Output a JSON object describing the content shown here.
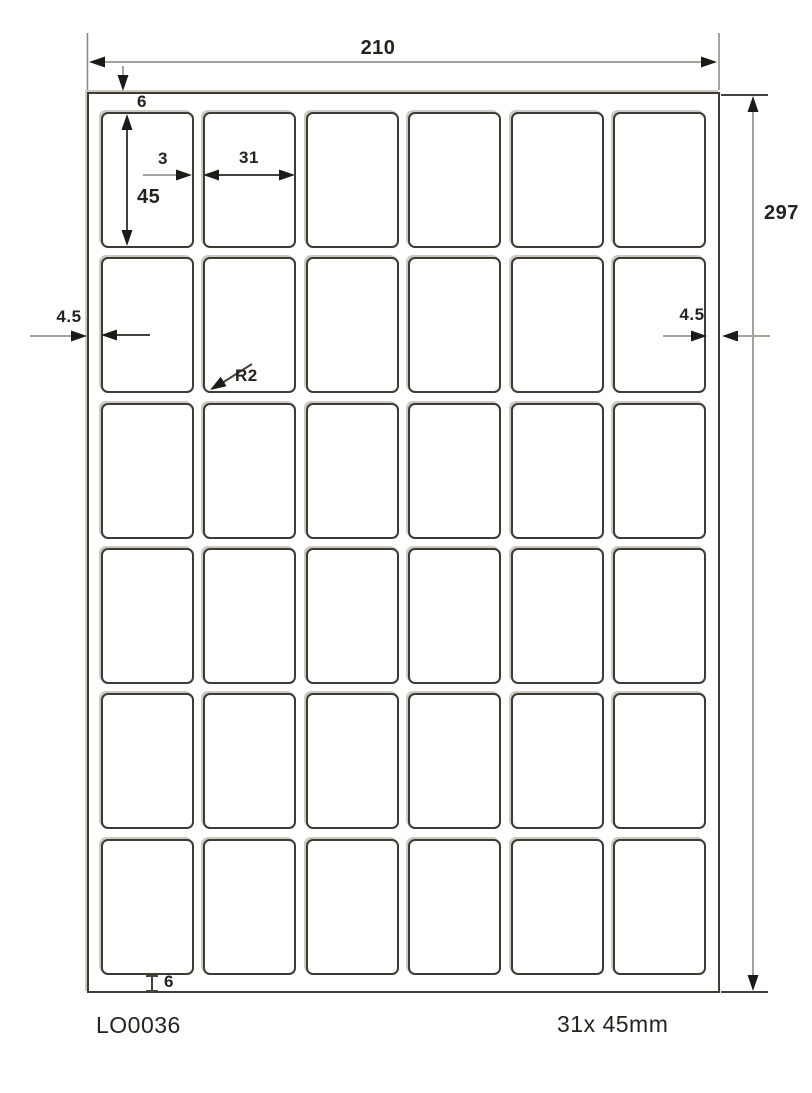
{
  "diagram": {
    "title": "label-sheet-dimension-drawing",
    "dims": {
      "sheet_width": "210",
      "sheet_height": "297",
      "top_margin": "6",
      "label_height": "45",
      "gap": "3",
      "label_width": "31",
      "left_margin": "4.5",
      "right_margin": "4.5",
      "corner_radius": "R2",
      "bottom_margin": "6"
    },
    "grid": {
      "rows": 6,
      "cols": 6
    },
    "footer": {
      "product_code": "LO0036",
      "label_size": "31x 45mm"
    },
    "style": {
      "ink_color": "#3f3a34",
      "dim_line_color": "#a6a19b"
    }
  }
}
